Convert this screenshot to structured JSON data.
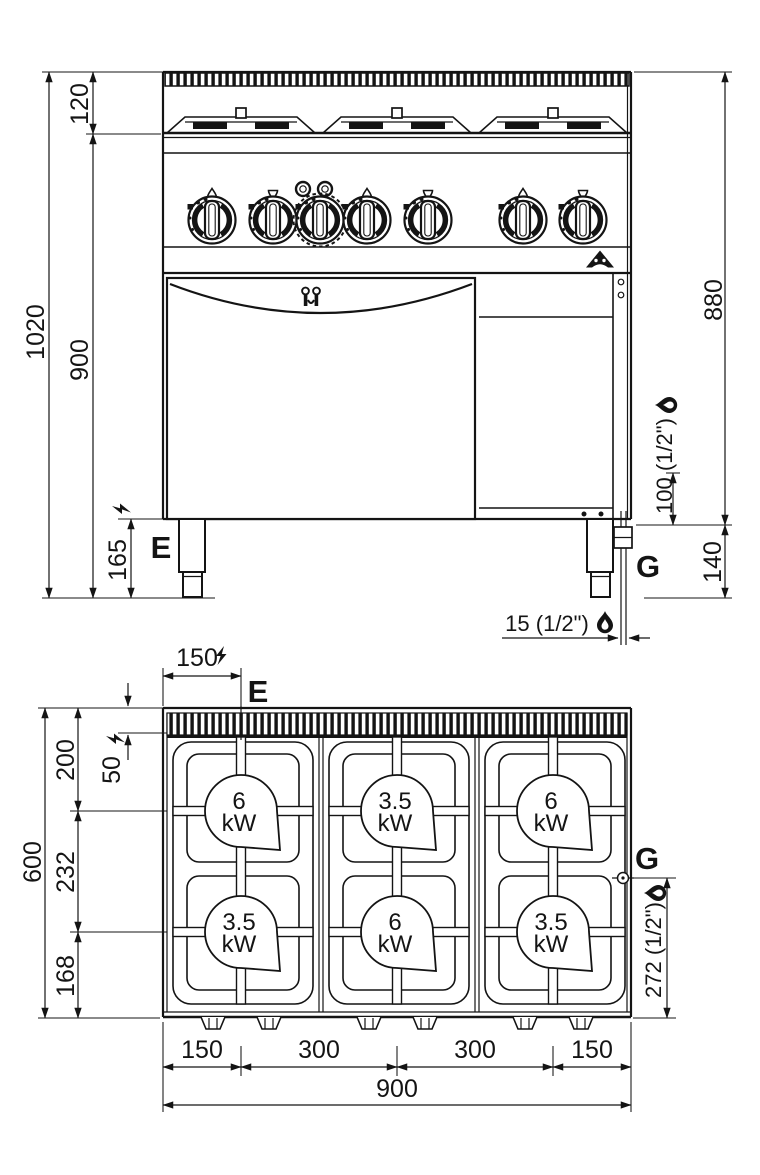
{
  "front_view": {
    "dim_total_height": "1020",
    "dim_top_section": "120",
    "dim_body_height": "900",
    "dim_leg_height": "165",
    "dim_top_to_gas_inlet": "880",
    "dim_gas_inlet_rise": "100 (1/2\")",
    "dim_gas_inlet_height": "140",
    "dim_gas_pipe_offset": "15 (1/2\")",
    "electric_label": "E",
    "gas_label": "G"
  },
  "plan_view": {
    "dim_electric_from_left": "150",
    "dim_electric_from_rear": "50",
    "dim_depth_total": "600",
    "dim_rear_to_row1": "200",
    "dim_row1_to_row2": "232",
    "dim_row2_to_front": "168",
    "dim_gas_from_front": "272 (1/2\")",
    "dim_width_total": "900",
    "dim_col_segments": [
      "150",
      "300",
      "300",
      "150"
    ],
    "electric_label": "E",
    "gas_label": "G",
    "burners": [
      {
        "power": "6",
        "unit": "kW"
      },
      {
        "power": "3.5",
        "unit": "kW"
      },
      {
        "power": "6",
        "unit": "kW"
      },
      {
        "power": "3.5",
        "unit": "kW"
      },
      {
        "power": "6",
        "unit": "kW"
      },
      {
        "power": "3.5",
        "unit": "kW"
      }
    ]
  },
  "colors": {
    "line": "#141414",
    "background": "#ffffff"
  }
}
